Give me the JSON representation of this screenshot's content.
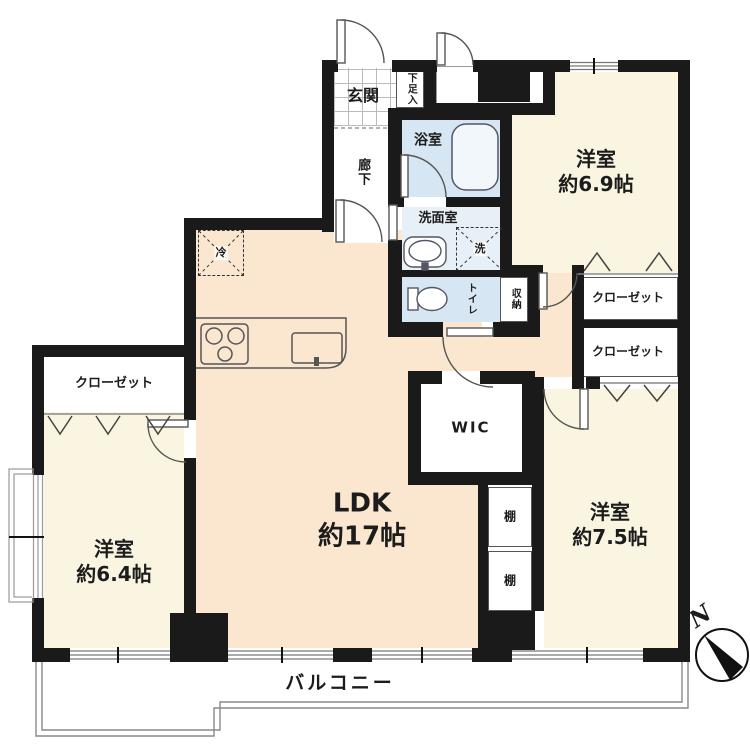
{
  "plan": {
    "rooms": {
      "genkan": {
        "label": "玄関"
      },
      "shoe_cabinet": {
        "label": "下足入"
      },
      "hallway": {
        "label": "廊下"
      },
      "bathroom": {
        "label": "浴室"
      },
      "washroom": {
        "label": "洗面室"
      },
      "washer": {
        "label": "洗"
      },
      "fridge": {
        "label": "冷"
      },
      "toilet": {
        "label": "トイレ"
      },
      "storage": {
        "label": "収納"
      },
      "bedroom_69": {
        "name": "洋室",
        "size": "約6.9帖"
      },
      "bedroom_75": {
        "name": "洋室",
        "size": "約7.5帖"
      },
      "bedroom_64": {
        "name": "洋室",
        "size": "約6.4帖"
      },
      "ldk": {
        "name": "LDK",
        "size": "約17帖"
      },
      "wic": {
        "label": "WIC"
      },
      "closet_left": {
        "label": "クローゼット"
      },
      "closet_right_upper": {
        "label": "クローゼット"
      },
      "closet_right_lower": {
        "label": "クローゼット"
      },
      "shelf_upper": {
        "label": "棚"
      },
      "shelf_lower": {
        "label": "棚"
      },
      "balcony": {
        "label": "バルコニー"
      }
    },
    "compass": {
      "north_label": "N"
    },
    "colors": {
      "wall": "#1a1a1a",
      "ldk_floor": "#fbe7cf",
      "bedroom_floor": "#faf5e1",
      "wet_area_floor": "#d7e6f3",
      "washroom_floor": "#e7eff7",
      "white": "#ffffff"
    }
  }
}
